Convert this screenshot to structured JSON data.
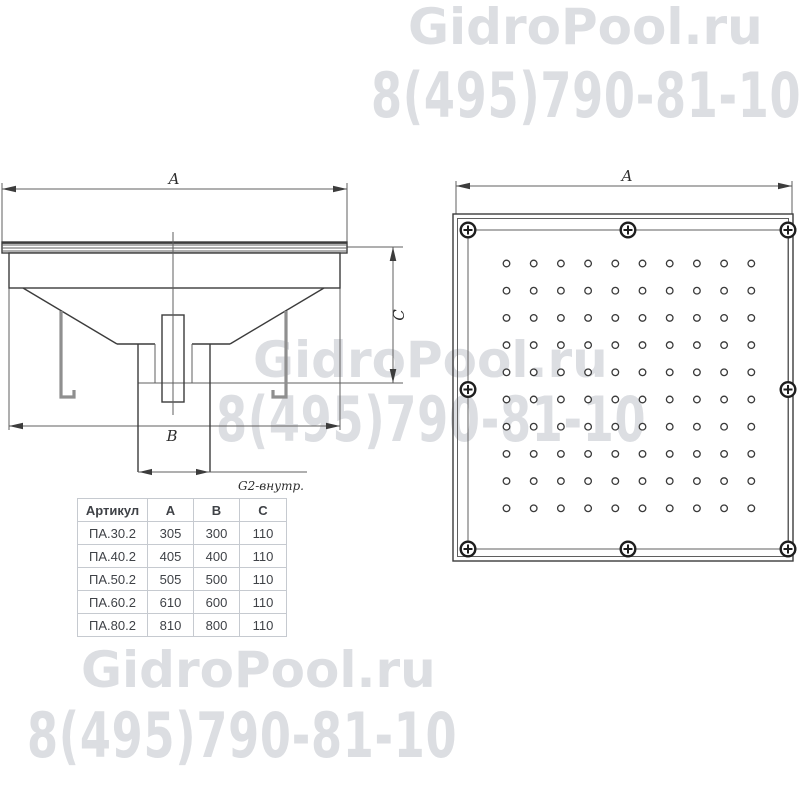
{
  "colors": {
    "line": "#3c3c3c",
    "thin_line": "#5f5f5f",
    "hook": "#8f8f8f",
    "watermark": "#dcdee2",
    "table_border": "#c6cad0",
    "table_text": "#3f4247"
  },
  "watermark": {
    "brand": "GidroPool.ru",
    "phone": "8(495)790-81-10"
  },
  "drawings": {
    "side_view": {
      "dim_a": "A",
      "dim_b": "B",
      "dim_c": "C",
      "thread_label": "G2-внутр."
    },
    "top_view": {
      "dim_a": "A",
      "hole_grid": {
        "rows": 10,
        "cols": 10
      },
      "screw_count": 8
    }
  },
  "table": {
    "headers": [
      "Артикул",
      "A",
      "B",
      "C"
    ],
    "rows": [
      [
        "ПА.30.2",
        "305",
        "300",
        "110"
      ],
      [
        "ПА.40.2",
        "405",
        "400",
        "110"
      ],
      [
        "ПА.50.2",
        "505",
        "500",
        "110"
      ],
      [
        "ПА.60.2",
        "610",
        "600",
        "110"
      ],
      [
        "ПА.80.2",
        "810",
        "800",
        "110"
      ]
    ]
  }
}
